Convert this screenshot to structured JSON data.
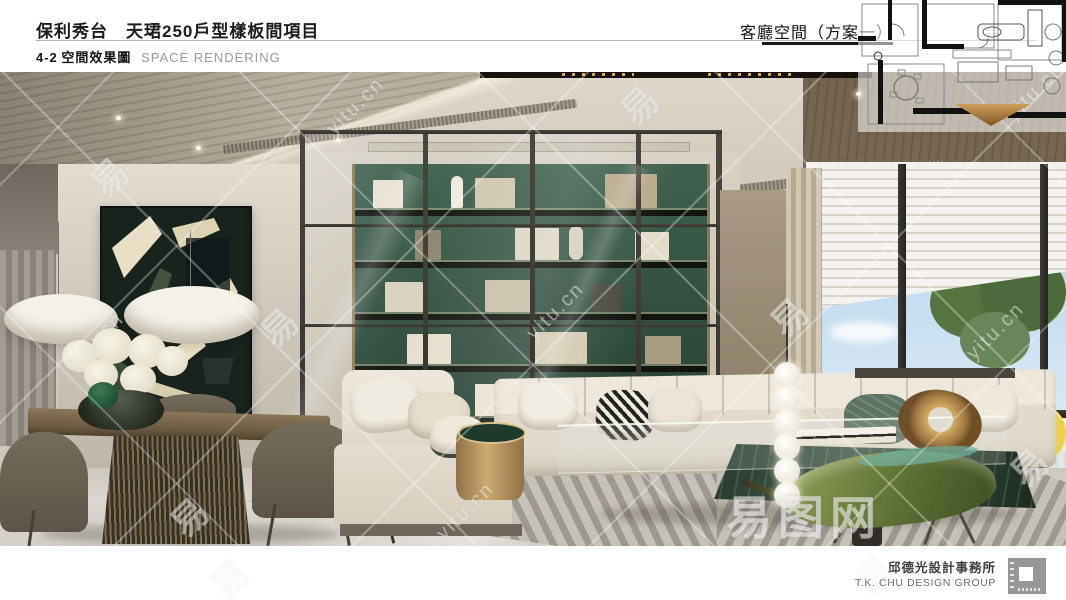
{
  "header": {
    "project_title": "保利秀台　天珺250戶型樣板間項目",
    "section_code": "4-2",
    "section_title_zh": "空間效果圖",
    "section_title_en": "SPACE RENDERING",
    "view_label": "客廳空間（方案一）"
  },
  "footer": {
    "firm_zh": "邱德光設計事務所",
    "firm_en": "T.K. CHU DESIGN GROUP"
  },
  "watermark": {
    "glyph": "易",
    "url_text": "yitu.cn",
    "brand_text": "易图网"
  },
  "colors": {
    "bookshelf_green": "#335143",
    "leaf_chair_green": "#5e7034",
    "view_cone_orange": "#b5813f",
    "sky_blue": "#a9cce8",
    "brass_gold": "#cbaa6e",
    "page_background": "#ffffff"
  }
}
